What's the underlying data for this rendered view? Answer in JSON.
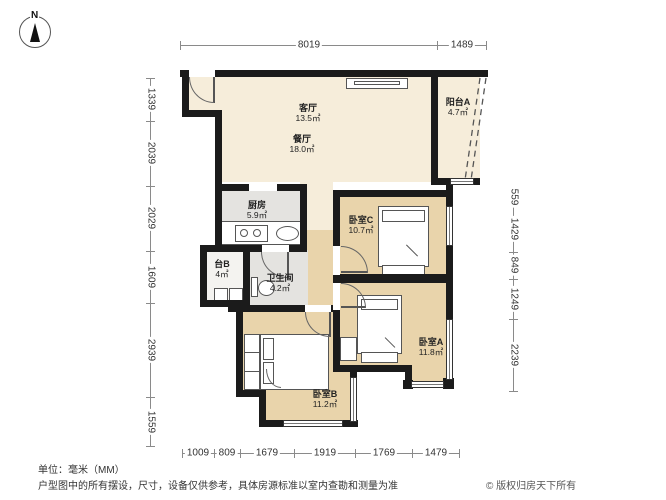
{
  "compass": {
    "label": "N"
  },
  "rooms": {
    "living": {
      "name": "客厅",
      "area": "13.5㎡"
    },
    "dining": {
      "name": "餐厅",
      "area": "18.0㎡"
    },
    "balcony_a": {
      "name": "阳台A",
      "area": "4.7㎡"
    },
    "kitchen": {
      "name": "厨房",
      "area": "5.9㎡"
    },
    "bedroom_c": {
      "name": "卧室C",
      "area": "10.7㎡"
    },
    "balcony_b": {
      "name": "台B",
      "area": "4㎡"
    },
    "bathroom": {
      "name": "卫生间",
      "area": "4.2㎡"
    },
    "bedroom_a": {
      "name": "卧室A",
      "area": "11.8㎡"
    },
    "bedroom_b": {
      "name": "卧室B",
      "area": "11.2㎡"
    }
  },
  "dims": {
    "top": [
      "8019",
      "1489"
    ],
    "left": [
      "1339",
      "2039",
      "2029",
      "1609",
      "2939",
      "1559"
    ],
    "right": [
      "559",
      "1429",
      "849",
      "1249",
      "2239"
    ],
    "bottom": [
      "1009",
      "809",
      "1679",
      "1919",
      "1769",
      "1479"
    ]
  },
  "footer": {
    "unit": "单位：毫米（MM）",
    "disclaimer": "户型图中的所有摆设，尺寸，设备仅供参考，具体房源标准以室内查勘和测量为准",
    "copyright": "© 版权归房天下所有"
  },
  "colors": {
    "wall": "#1b1b1b",
    "floor_public": "#f6edda",
    "floor_bedroom": "#e9d4ab",
    "floor_wet": "#e4e3e0",
    "dim_line": "#8a8a8a"
  }
}
